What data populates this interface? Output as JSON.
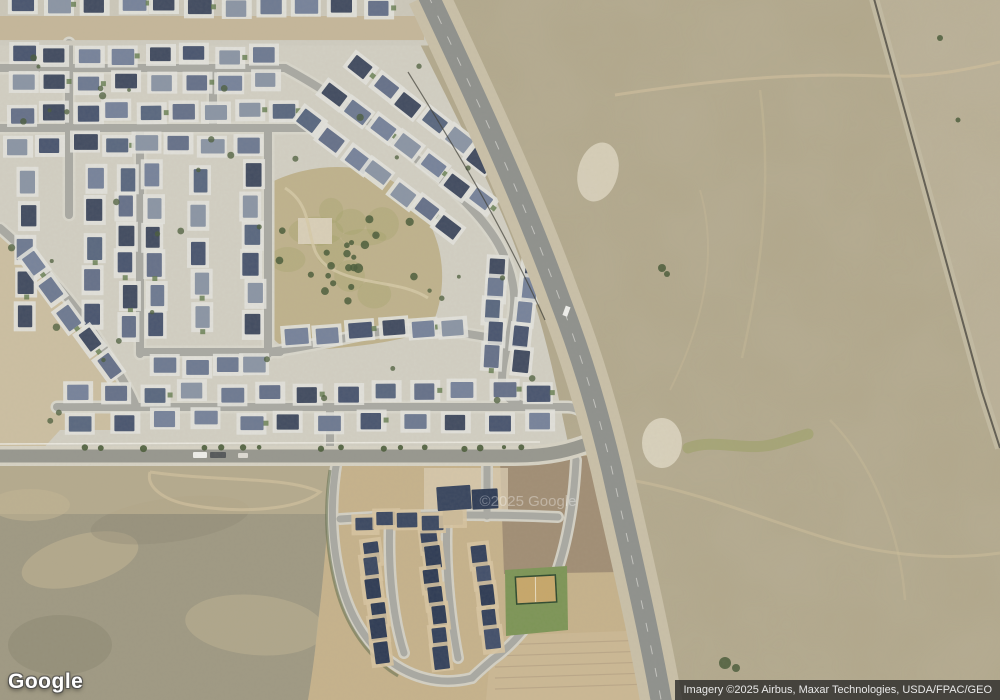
{
  "branding": {
    "logo_text": "Google",
    "watermark_text": "©2025 Google"
  },
  "attribution": {
    "text": "Imagery ©2025 Airbus, Maxar Technologies, USDA/FPAC/GEO"
  },
  "palette": {
    "desert_base": "#b1a78b",
    "desert_far": "#bbb197",
    "scrub": "#9f9983",
    "concrete": "#d2cfc3",
    "street": "#a9a9a3",
    "street_casing": "#d8d6cb",
    "arterial": "#97978f",
    "highway_pavement": "#8f918d",
    "highway_shoulder": "#c9c0a8",
    "rail_gravel": "#c3bba3",
    "rail_line": "#504c44",
    "dirt": "#c6b28c",
    "dirt_dark": "#9c8a72",
    "park": "#bfb28d",
    "grass": "#7d9557",
    "court": "#c7a76a",
    "pad": "#e3e2dd",
    "townhouse_pad": "#d7c4a0",
    "tree": "#4a5c3a",
    "fence": "#3c3c34",
    "trail": "#cfbf9c",
    "white_patch": "#ded7c3",
    "olive": "#9aa05f",
    "roofs": [
      "#5a6880",
      "#4a5670",
      "#6e7a92",
      "#8b95a5",
      "#424c61",
      "#66718a",
      "#77839b"
    ],
    "townhouse_roofs": [
      "#3c4962",
      "#35425c",
      "#43506b",
      "#2f3c55"
    ]
  }
}
